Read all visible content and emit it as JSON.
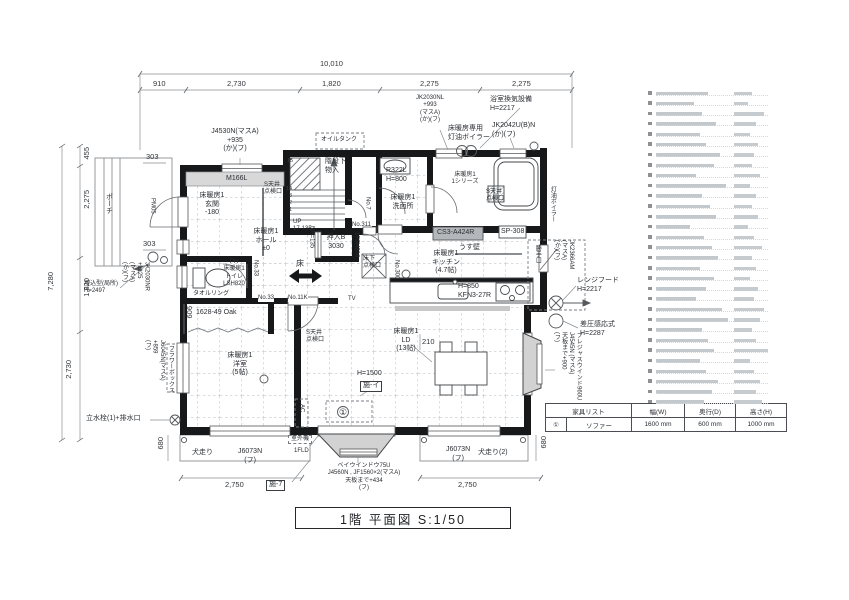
{
  "title_block": {
    "text": "1階 平面図 S:1/50"
  },
  "dims": {
    "overall_w": "10,010",
    "top": [
      "910",
      "2,730",
      "1,820",
      "2,275",
      "2,275"
    ],
    "overall_h": "7,280",
    "left": [
      "455",
      "2,275",
      "1,820",
      "2,730"
    ],
    "bottom_left": "2,750",
    "bottom_right": "2,750",
    "d303a": "303",
    "d303b": "303",
    "d606": "606",
    "d680l": "680",
    "d680r": "680",
    "d210": "210"
  },
  "rooms": {
    "genkan": "床暖房1\n玄関\n-180",
    "hall": "床暖房1\nホール\n±0",
    "toilet": "PH\n床暖房1\nトイレ\nLSH820",
    "yoshitsu": "床暖房1\n洋室\n(5帖)",
    "ld": "床暖房1\nLD\n(13帖)",
    "kitchen": "床暖房1\nキッチン\n(4.7帖)",
    "senmenjo": "床暖房1\n洗面所",
    "bath": "床暖房1\n1シリーズ",
    "oshiire": "押入B\n3030",
    "stair_closet": "階段下\n物入"
  },
  "labels": {
    "porch": "ポーチ",
    "pm05": "PM05",
    "m166l": "M166L",
    "j4530": "J4530N(マスA)\n+935\n(か)(フ)",
    "oil_tank": "オイルタンク",
    "jk2030nl": "JK2030NL\n+993\n(マスA)\n(か)(フ)",
    "bath_vent": "浴室換気設備\nH=2217",
    "jk2042": "JK2042U(B)N\n(か)(フ)",
    "boiler_heater": "床暖房専用\n灯油ボイラー",
    "toyu_boiler": "灯油ボイラー",
    "s_tenjo_a": "S天井\n点検口",
    "s_tenjo_b": "S天井\n点検口",
    "s_tenjo_c": "S天井\n点検口",
    "r322l": "R322L\nH=800",
    "up": "UP\n17-135",
    "yukashita": "床下\n点検口",
    "yuka": "床",
    "no33v": "No.33",
    "no33": "No.33",
    "no11k": "No.11K",
    "no7": "No.7",
    "no311": "No.311",
    "no300": "No.300",
    "nh135": "NH=135",
    "fsh816": "1FSH816",
    "towel": "タオルリング",
    "oak": "1628-49 Oak",
    "cs3": "CS3-A424R",
    "sp308": "SP-308",
    "usukabe": "うす壁",
    "h850": "H=850\nKFN3-27R",
    "katteguchi": "勝手口",
    "jk2366": "JK2366AM\n(マスA)\n(か)(フ)",
    "range_hood": "レンジフード\nH=2217",
    "sapressure": "差圧感応式\nH=2287",
    "tv": "TV",
    "h1500": "H=1500",
    "se_i": "施-イ",
    "se_7": "施-7",
    "ac": "AC",
    "outdoor": "室外機",
    "fld": "1FLD",
    "bay_bottom": "ベイウインドウ75U\nJ4560N , JF1560×2(マスA)\n天板まで+434\n(フ)",
    "bay_right": "プレジャスウインド960U\nJ4545N (マスA)\n天板まで+900\n(フ)",
    "inubashiri_l": "犬走り",
    "j6073l": "J6073N\n(フ)",
    "j6073r": "J6073N\n(フ)",
    "inubashiri_r": "犬走り(2)",
    "jk2030nr": "JK2030NR\n+1125\n(マスA)\n(か)(フ)",
    "umekomi": "埋込型(局所)\nH=2497",
    "rissuisen": "立水栓(1)+排水口",
    "j6045": "J6045N(マスA)\n+859\n(フ)",
    "flowerbox": "フラワーボックス",
    "circle1": "①"
  },
  "stairs": {
    "numbers": [
      "15",
      "14",
      "3",
      "2",
      "1"
    ]
  },
  "furniture_table": {
    "headers": [
      "家具リスト",
      "幅(W)",
      "奥行(D)",
      "高さ(H)"
    ],
    "row": {
      "no": "①",
      "name": "ソファー",
      "w": "1600 mm",
      "d": "600 mm",
      "h": "1000 mm"
    }
  },
  "legend": {
    "row_count": 31
  },
  "colors": {
    "wall": "#17181a",
    "gray_fill": "#d2d2d2",
    "grid": "#cdd2d6",
    "legend_text": "#c3c8cc"
  }
}
